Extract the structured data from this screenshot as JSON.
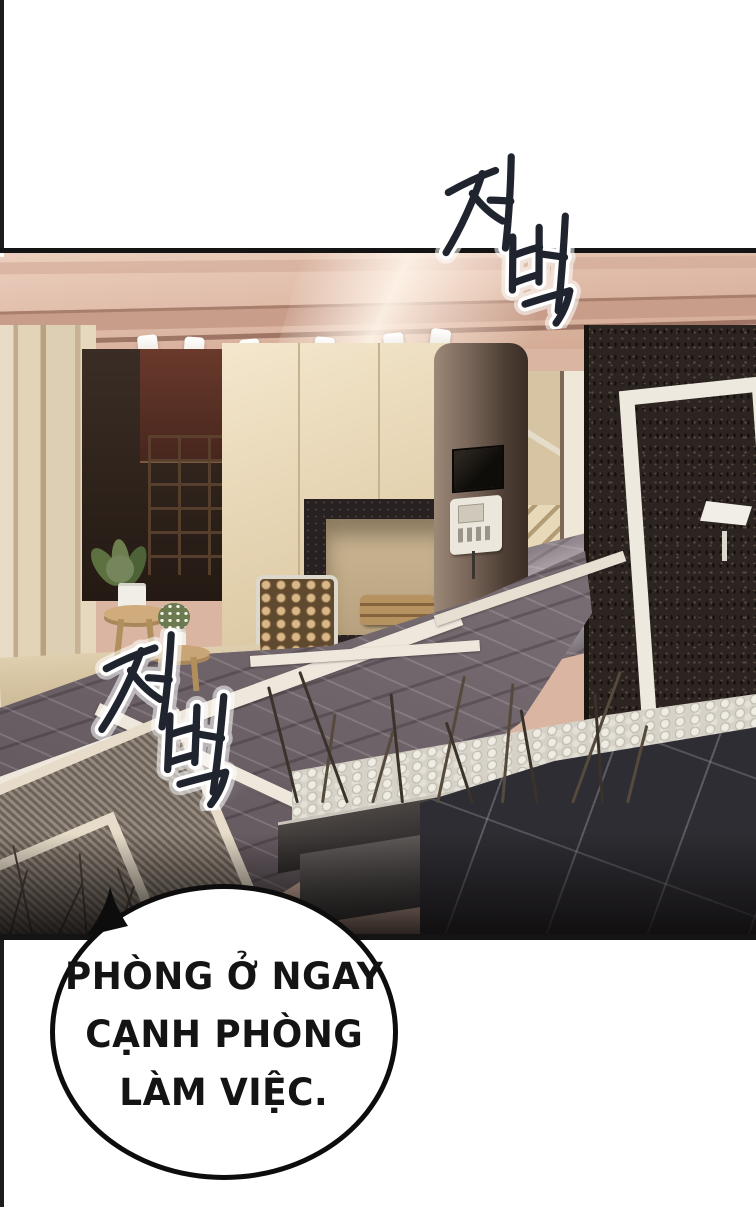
{
  "page": {
    "kind": "webtoon comic panel",
    "alt_text": "Luxurious interior: warm-lit beamed ceiling with spotlights, beige pillars, dark bar cabinet, fireplace with firewood, intercom column, staircase, dark speckled stone wall with white door frame and wall lamp, plants on wooden stools, gray marble floor with white border strips, pebble planter with bare branches, dark tile foreground."
  },
  "colors": {
    "page_bg": "#ffffff",
    "edge_strip": "#1c1c1c",
    "panel_border": "#141414",
    "ceiling": "#e3bfae",
    "beige_wall": "#e6d3ad",
    "dark_stone_wall": "#2c2420",
    "marble_floor": "#766c71",
    "sfx_ink": "#20242f",
    "sfx_outline": "#ffffff",
    "bubble_fill": "#ffffff",
    "bubble_border": "#0d0d0d",
    "bubble_text": "#141414"
  },
  "sfx": [
    {
      "id": "sfx-top",
      "text": "저벅",
      "meaning": "footstep sound"
    },
    {
      "id": "sfx-left",
      "text": "저벅",
      "meaning": "footstep sound"
    }
  ],
  "speech_bubble": {
    "lines": [
      "PHÒNG Ở NGAY",
      "CẠNH PHÒNG",
      "LÀM VIỆC."
    ],
    "full_text": "PHÒNG Ở NGAY CẠNH PHÒNG LÀM VIỆC."
  }
}
